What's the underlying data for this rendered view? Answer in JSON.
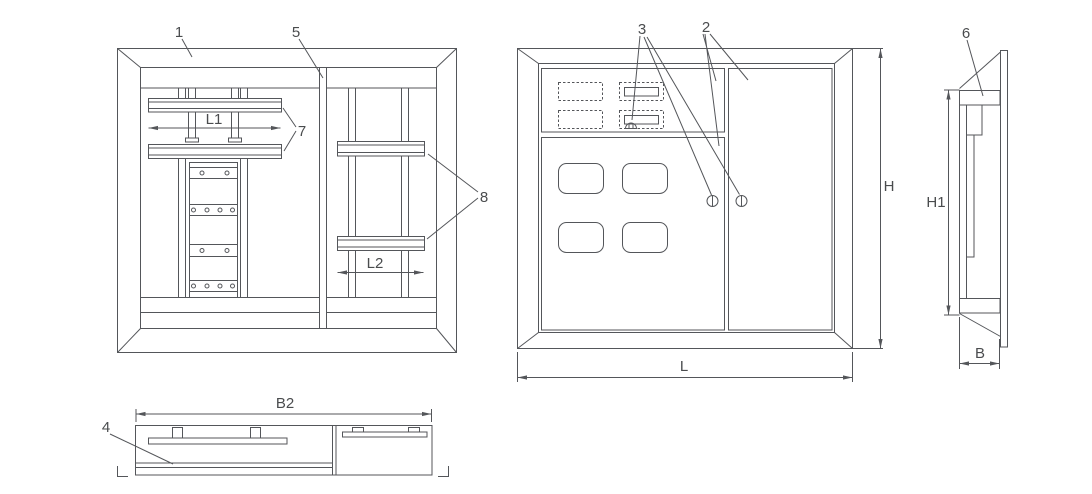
{
  "colors": {
    "background": "#ffffff",
    "line": "#54565a",
    "text": "#4a4c4e"
  },
  "views": {
    "internal": {
      "parts": {
        "p1": "1",
        "p5": "5",
        "p7": "7",
        "p8": "8"
      },
      "dims": {
        "l1": "L1",
        "l2": "L2"
      }
    },
    "front": {
      "parts": {
        "p2": "2",
        "p3": "3"
      },
      "dims": {
        "h": "H",
        "l": "L"
      }
    },
    "side": {
      "parts": {
        "p6": "6"
      },
      "dims": {
        "h1": "H1",
        "b": "B"
      }
    },
    "bottom": {
      "parts": {
        "p4": "4"
      },
      "dims": {
        "b2": "B2"
      }
    }
  }
}
